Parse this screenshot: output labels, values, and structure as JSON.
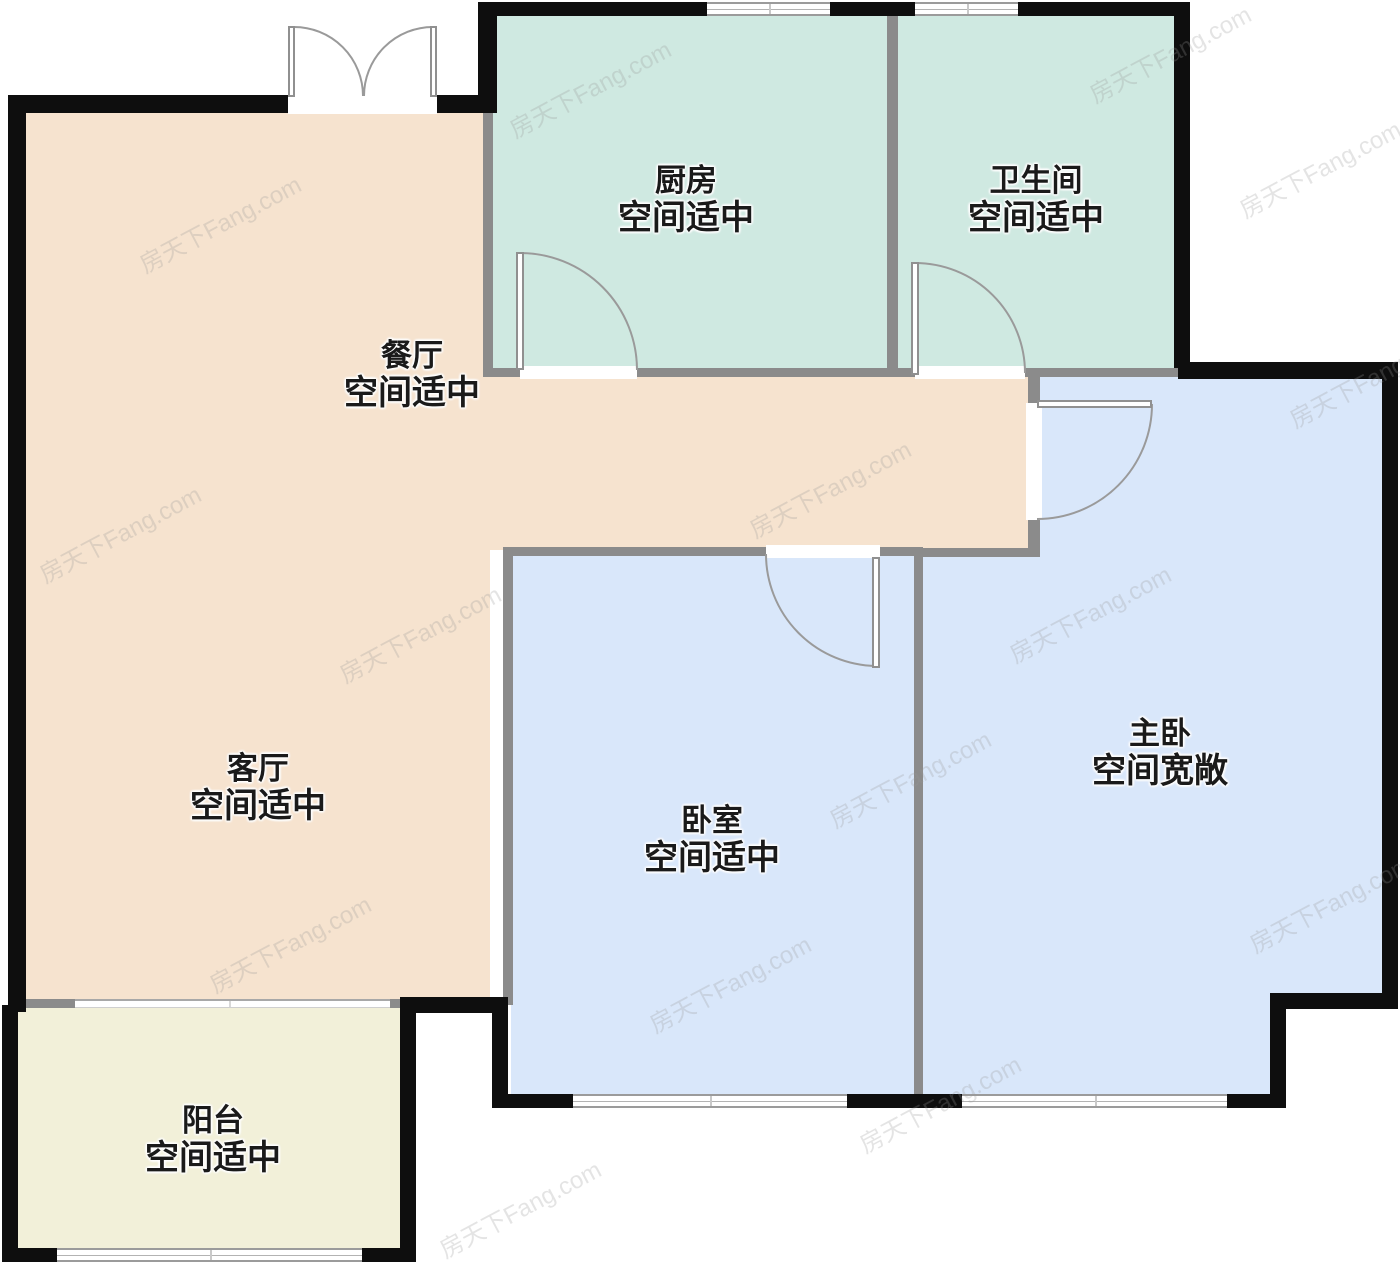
{
  "watermark": {
    "text": "房天下Fang.com"
  },
  "rooms": [
    {
      "id": "dining",
      "name": "餐厅",
      "status": "空间适中"
    },
    {
      "id": "kitchen",
      "name": "厨房",
      "status": "空间适中"
    },
    {
      "id": "bathroom",
      "name": "卫生间",
      "status": "空间适中"
    },
    {
      "id": "master-bedroom",
      "name": "主卧",
      "status": "空间宽敞"
    },
    {
      "id": "living-room",
      "name": "客厅",
      "status": "空间适中"
    },
    {
      "id": "bedroom",
      "name": "卧室",
      "status": "空间适中"
    },
    {
      "id": "balcony",
      "name": "阳台",
      "status": "空间适中"
    }
  ],
  "colors": {
    "wall_black": "#0e0e0e",
    "wall_gray": "#8b8b8b",
    "room_dining_living": "#f6e3cf",
    "room_kitchen_bath": "#cfe9e1",
    "room_bedrooms": "#d9e7fa",
    "room_balcony": "#f2f0d9",
    "door_arc": "#9a9a9a",
    "label_text": "#1a1a1a"
  }
}
